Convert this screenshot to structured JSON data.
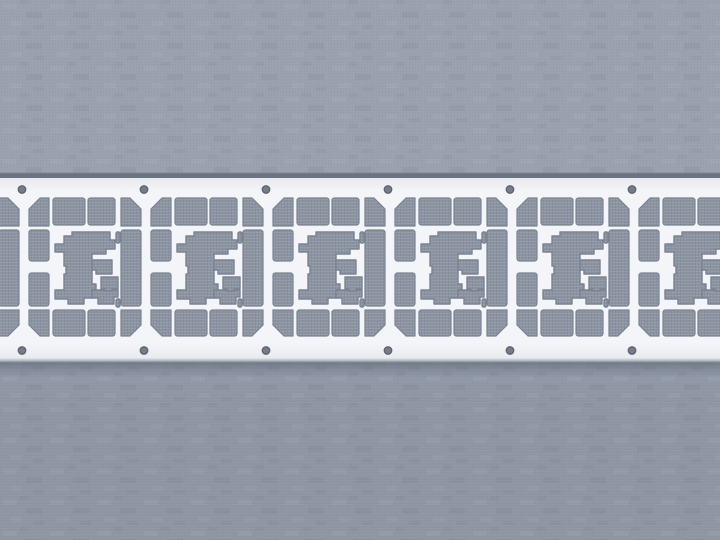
{
  "scene": {
    "description": "Photograph of a stamped sheet-metal lead frame strip (repeating semiconductor lead-frame units) lying horizontally on a gray woven fabric background",
    "object": "lead-frame-strip",
    "text_content": "none",
    "strip": {
      "top_y": 178,
      "bottom_y": 362,
      "top_edge_line_y": 173.4,
      "shadow_height": 16
    },
    "cells": {
      "pitch": 122,
      "count": 7,
      "hole_xs": [
        -100,
        22,
        144,
        266,
        388,
        510,
        632
      ],
      "unit": "repeating lead-frame frame: octagonal outline of slot openings around a central C-shaped die-pad cutout"
    },
    "holes": {
      "radius": 3.7,
      "top_cy": 189.5,
      "bottom_cy": 350.5,
      "per_cell": 2
    },
    "colors": {
      "bg_top": "#9aa2af",
      "bg_bottom": "#8e96a4",
      "op_base": "#8c94a2",
      "strip_mid": "#f4f5f8",
      "strip_edge": "#e7e9ee",
      "edge_top_line": "#6b7280",
      "edge_bottom_line": "#c9ced5",
      "edge_bottom_dark": "#9aa1ad",
      "shadow": "#4f5a6a",
      "rim": "#7a8391",
      "hole_fill": "#757d8b",
      "hole_rim": "#5d6472",
      "weave_light": "#a2a9b5",
      "weave_dark": "#848c9b"
    }
  }
}
